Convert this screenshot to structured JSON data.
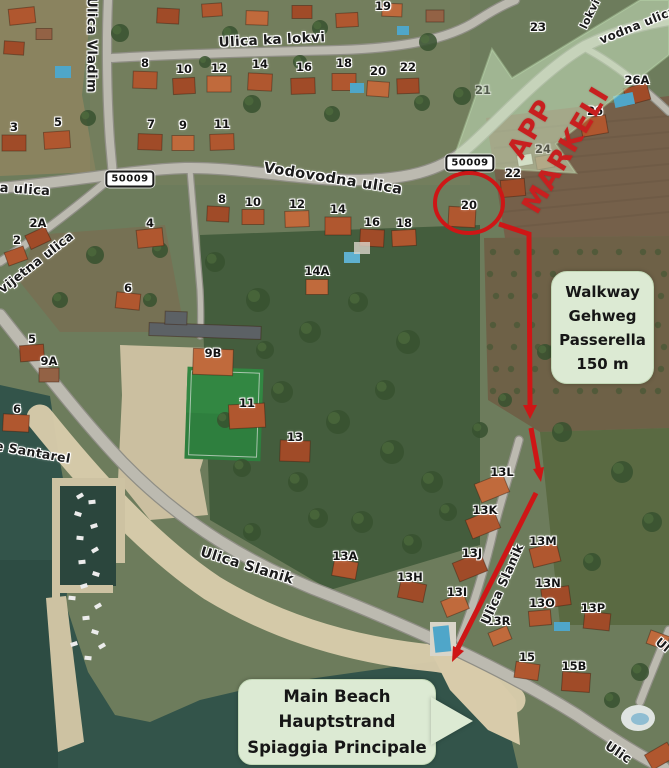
{
  "annotations": {
    "app_markeli": {
      "line1": "APP",
      "line2": "MARKELI",
      "color": "#c81f1f"
    },
    "walkway_box": {
      "lines": [
        "Walkway",
        "Gehweg",
        "Passerella",
        "150 m"
      ],
      "bg": "#dcead3"
    },
    "beach_box": {
      "lines": [
        "Main Beach",
        "Hauptstrand",
        "Spiaggia Principale"
      ],
      "bg": "#dcead3"
    },
    "route_signs": [
      {
        "number": "50009"
      },
      {
        "number": "50009"
      }
    ],
    "highlight": {
      "circled_house": "20",
      "arrow_color": "#ce1616"
    }
  },
  "street_labels": [
    {
      "text": "Ulica Vladim",
      "x": 91,
      "y": 45,
      "rot": 90,
      "size": 13
    },
    {
      "text": "Ulica ka lokvi",
      "x": 272,
      "y": 40,
      "rot": -3,
      "size": 13.5
    },
    {
      "text": "Vodovodna ulica",
      "x": 333,
      "y": 179,
      "rot": 9,
      "size": 14.5
    },
    {
      "text": "a ulica",
      "x": 25,
      "y": 190,
      "rot": 4,
      "size": 13
    },
    {
      "text": "vijetna ulica",
      "x": 36,
      "y": 262,
      "rot": -38,
      "size": 12.5
    },
    {
      "text": "e Santarel",
      "x": 33,
      "y": 452,
      "rot": 10,
      "size": 12.5
    },
    {
      "text": "Ulica Slanik",
      "x": 247,
      "y": 566,
      "rot": 17,
      "size": 14
    },
    {
      "text": "Ulica Slanik",
      "x": 502,
      "y": 584,
      "rot": -66,
      "size": 12.5
    },
    {
      "text": "lokvi",
      "x": 590,
      "y": 14,
      "rot": -64,
      "size": 11
    },
    {
      "text": "vodna ulica",
      "x": 638,
      "y": 25,
      "rot": -22,
      "size": 12
    },
    {
      "text": "Ulic",
      "x": 618,
      "y": 753,
      "rot": 34,
      "size": 13
    },
    {
      "text": "Ul",
      "x": 663,
      "y": 645,
      "rot": 40,
      "size": 12
    }
  ],
  "house_numbers": [
    {
      "text": "19",
      "x": 383,
      "y": 6
    },
    {
      "text": "8",
      "x": 145,
      "y": 63
    },
    {
      "text": "10",
      "x": 184,
      "y": 69
    },
    {
      "text": "12",
      "x": 219,
      "y": 68
    },
    {
      "text": "14",
      "x": 260,
      "y": 64
    },
    {
      "text": "16",
      "x": 304,
      "y": 67
    },
    {
      "text": "18",
      "x": 344,
      "y": 63
    },
    {
      "text": "20",
      "x": 378,
      "y": 71
    },
    {
      "text": "22",
      "x": 408,
      "y": 67
    },
    {
      "text": "23",
      "x": 538,
      "y": 27
    },
    {
      "text": "21",
      "x": 483,
      "y": 90,
      "faint": true
    },
    {
      "text": "26A",
      "x": 637,
      "y": 80
    },
    {
      "text": "26",
      "x": 595,
      "y": 111
    },
    {
      "text": "24",
      "x": 543,
      "y": 149,
      "faint": true
    },
    {
      "text": "3",
      "x": 14,
      "y": 127
    },
    {
      "text": "5",
      "x": 58,
      "y": 122
    },
    {
      "text": "7",
      "x": 151,
      "y": 124
    },
    {
      "text": "9",
      "x": 183,
      "y": 125
    },
    {
      "text": "11",
      "x": 222,
      "y": 124
    },
    {
      "text": "2A",
      "x": 38,
      "y": 223
    },
    {
      "text": "2",
      "x": 17,
      "y": 240
    },
    {
      "text": "4",
      "x": 150,
      "y": 223
    },
    {
      "text": "8",
      "x": 222,
      "y": 199
    },
    {
      "text": "10",
      "x": 253,
      "y": 202
    },
    {
      "text": "12",
      "x": 297,
      "y": 204
    },
    {
      "text": "14",
      "x": 338,
      "y": 209
    },
    {
      "text": "16",
      "x": 372,
      "y": 222
    },
    {
      "text": "18",
      "x": 404,
      "y": 223
    },
    {
      "text": "14A",
      "x": 317,
      "y": 271
    },
    {
      "text": "20",
      "x": 469,
      "y": 205
    },
    {
      "text": "22",
      "x": 513,
      "y": 173
    },
    {
      "text": "6",
      "x": 128,
      "y": 288
    },
    {
      "text": "5",
      "x": 32,
      "y": 339
    },
    {
      "text": "9A",
      "x": 49,
      "y": 361
    },
    {
      "text": "6",
      "x": 17,
      "y": 409
    },
    {
      "text": "9B",
      "x": 213,
      "y": 353
    },
    {
      "text": "11",
      "x": 247,
      "y": 403
    },
    {
      "text": "13",
      "x": 295,
      "y": 437
    },
    {
      "text": "13A",
      "x": 345,
      "y": 556
    },
    {
      "text": "13H",
      "x": 410,
      "y": 577
    },
    {
      "text": "13L",
      "x": 502,
      "y": 472
    },
    {
      "text": "13K",
      "x": 485,
      "y": 510
    },
    {
      "text": "13J",
      "x": 472,
      "y": 553
    },
    {
      "text": "13M",
      "x": 543,
      "y": 541
    },
    {
      "text": "13I",
      "x": 457,
      "y": 592
    },
    {
      "text": "13N",
      "x": 548,
      "y": 583
    },
    {
      "text": "13O",
      "x": 542,
      "y": 603
    },
    {
      "text": "13P",
      "x": 593,
      "y": 608
    },
    {
      "text": "13R",
      "x": 498,
      "y": 621
    },
    {
      "text": "15",
      "x": 527,
      "y": 657
    },
    {
      "text": "15B",
      "x": 574,
      "y": 666
    }
  ]
}
